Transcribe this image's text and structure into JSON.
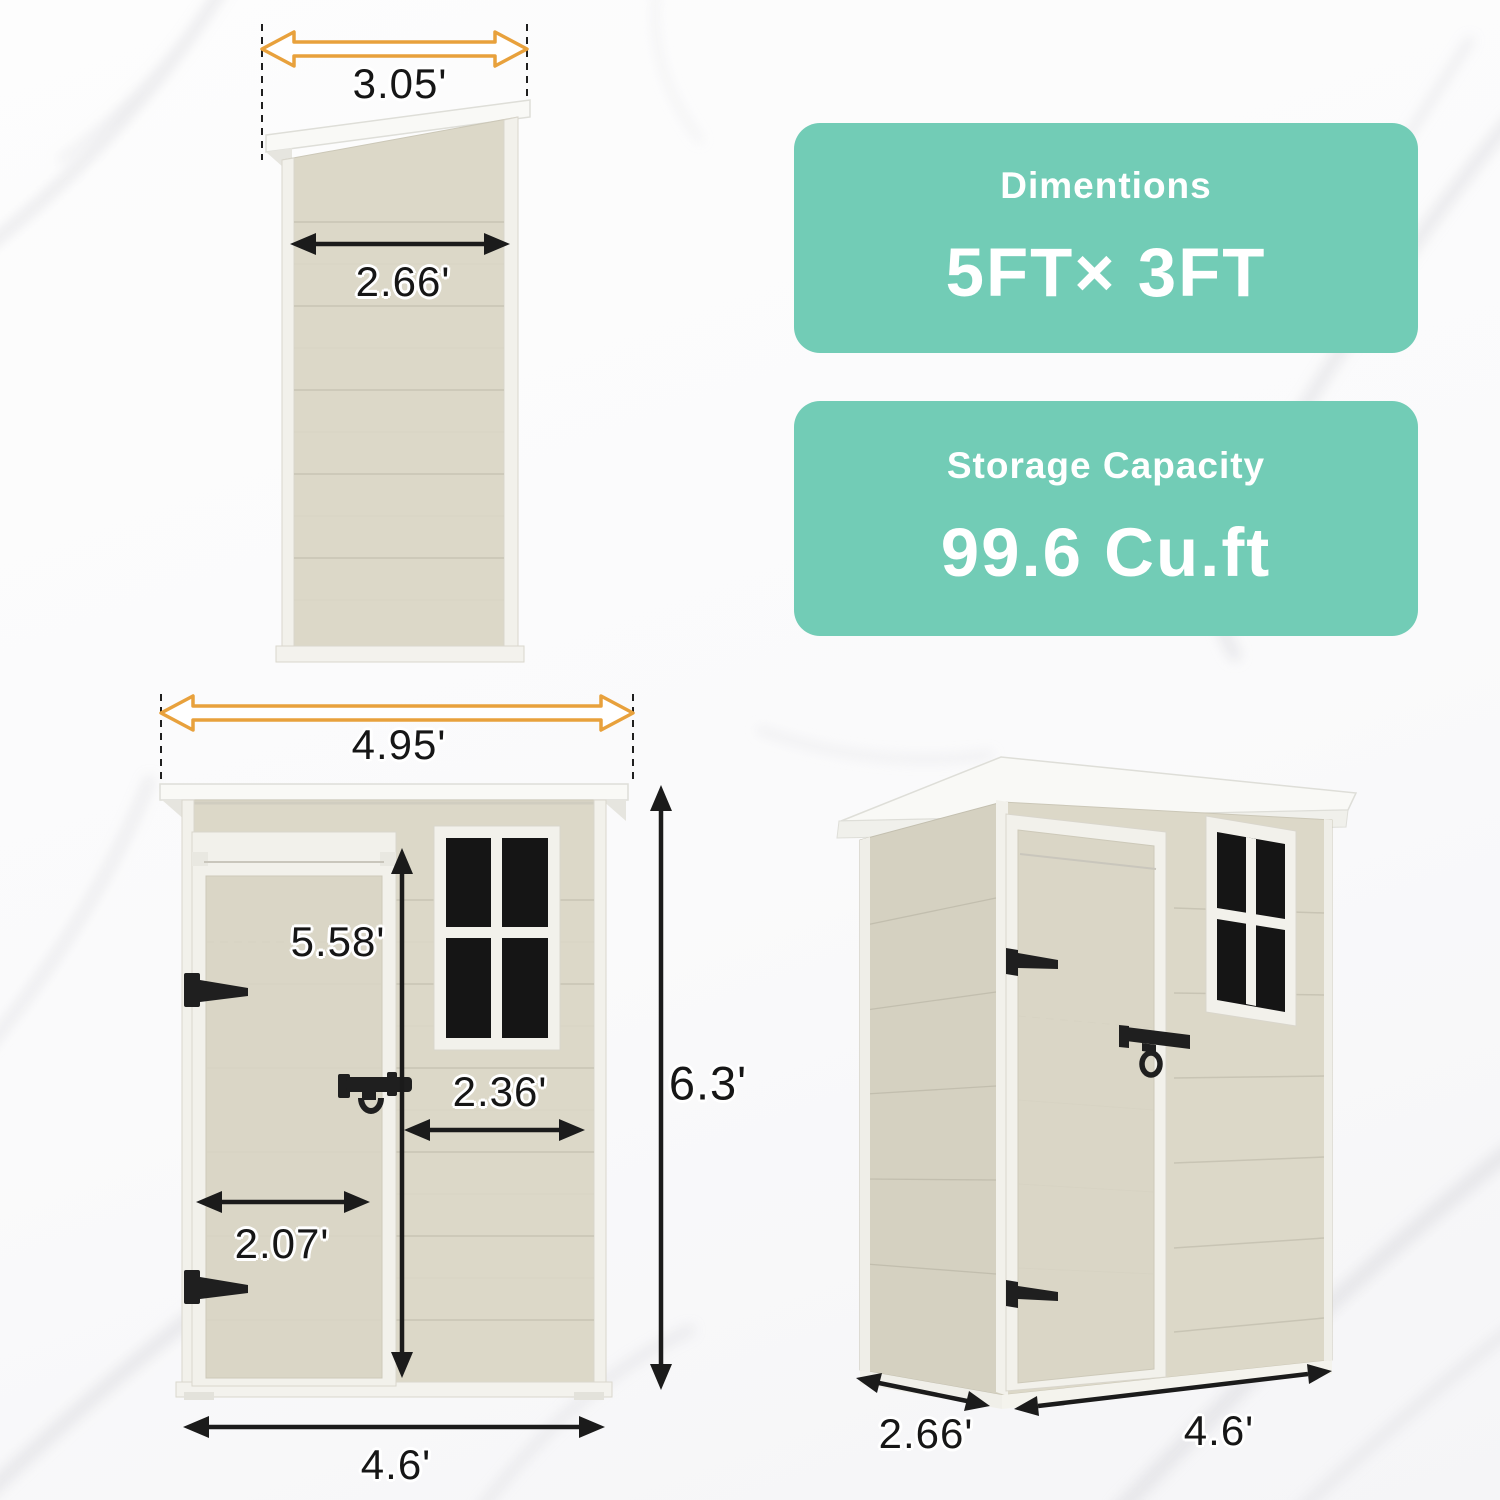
{
  "side_view": {
    "roof_width": "3.05'",
    "body_width": "2.66'"
  },
  "front_view": {
    "roof_width": "4.95'",
    "door_height": "5.58'",
    "panel_width": "2.36'",
    "door_width": "2.07'",
    "base_width": "4.6'",
    "total_height": "6.3'"
  },
  "perspective_view": {
    "depth": "2.66'",
    "width": "4.6'"
  },
  "badges": [
    {
      "title": "Dimentions",
      "value": "5FT× 3FT"
    },
    {
      "title": "Storage Capacity",
      "value": "99.6 Cu.ft"
    }
  ],
  "colors": {
    "badge_teal": "#72CCB6",
    "wall_beige": "#DCD8C8",
    "roof_white": "#F9F9F6",
    "window_glass": "#151515",
    "arrow_orange": "#E8A13C",
    "arrow_black": "#1B1B1B"
  }
}
